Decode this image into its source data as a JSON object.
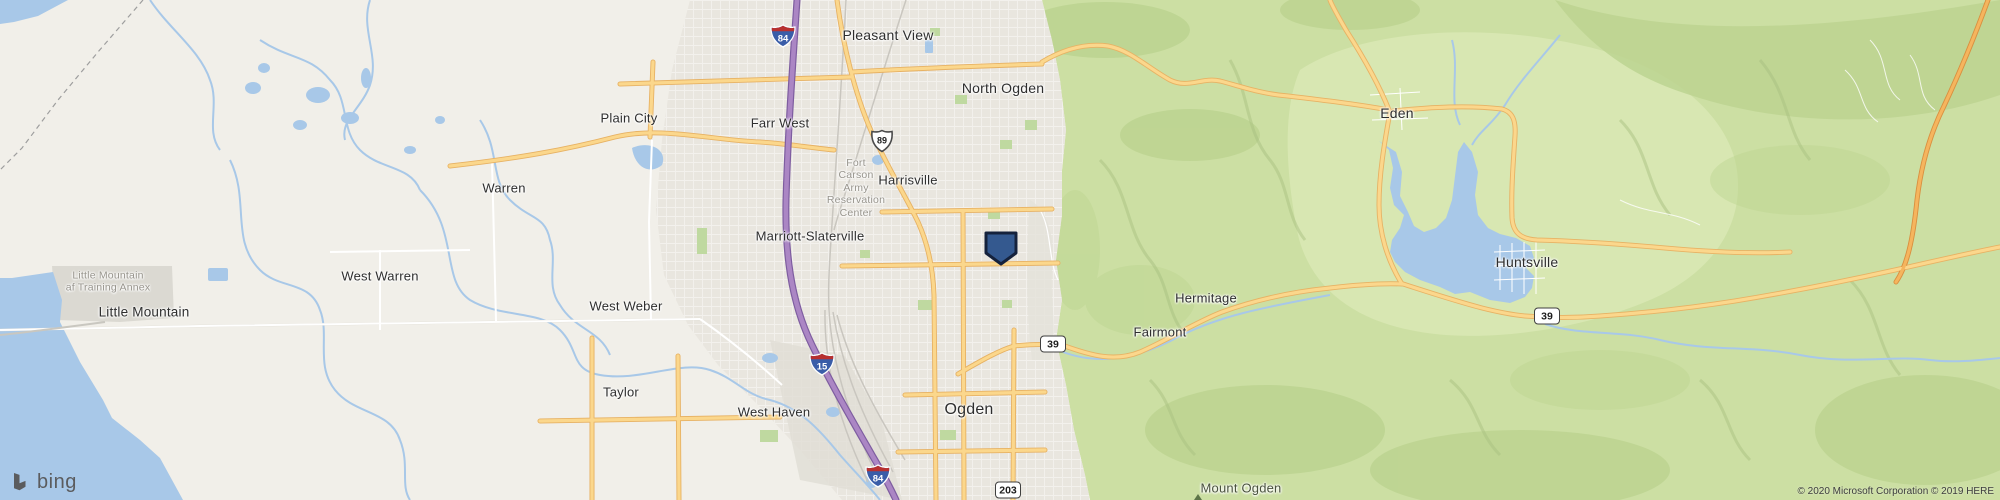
{
  "map": {
    "labels": {
      "pleasant_view": "Pleasant View",
      "north_ogden": "North Ogden",
      "plain_city": "Plain City",
      "farr_west": "Farr West",
      "harrisville": "Harrisville",
      "marriott_slaterville": "Marriott-Slaterville",
      "warren": "Warren",
      "west_warren": "West Warren",
      "west_weber": "West Weber",
      "little_mountain": "Little Mountain",
      "taylor": "Taylor",
      "west_haven": "West Haven",
      "ogden": "Ogden",
      "eden": "Eden",
      "huntsville": "Huntsville",
      "hermitage": "Hermitage",
      "fairmont": "Fairmont",
      "mount_ogden": "Mount Ogden"
    },
    "military": {
      "fort_carson_line1": "Fort",
      "fort_carson_line2": "Carson",
      "fort_carson_line3": "Army",
      "fort_carson_line4": "Reservation",
      "fort_carson_line5": "Center",
      "annex_line1": "Little Mountain",
      "annex_line2": "af Training Annex"
    },
    "shields": {
      "i84": "84",
      "i15": "15",
      "us89": "89",
      "sr39": "39",
      "sr203": "203"
    },
    "logo_text": "bing",
    "attribution": "© 2020 Microsoft Corporation © 2019 HERE",
    "colors": {
      "water": "#a8c8e8",
      "terrain_green": "#ccdfa3",
      "valley_beige": "#f1efe9",
      "urban_gray": "#e9e6df",
      "road_yellow": "#fbd78c",
      "freeway_purple": "#ab86c4",
      "marker_blue": "#34598f"
    }
  }
}
